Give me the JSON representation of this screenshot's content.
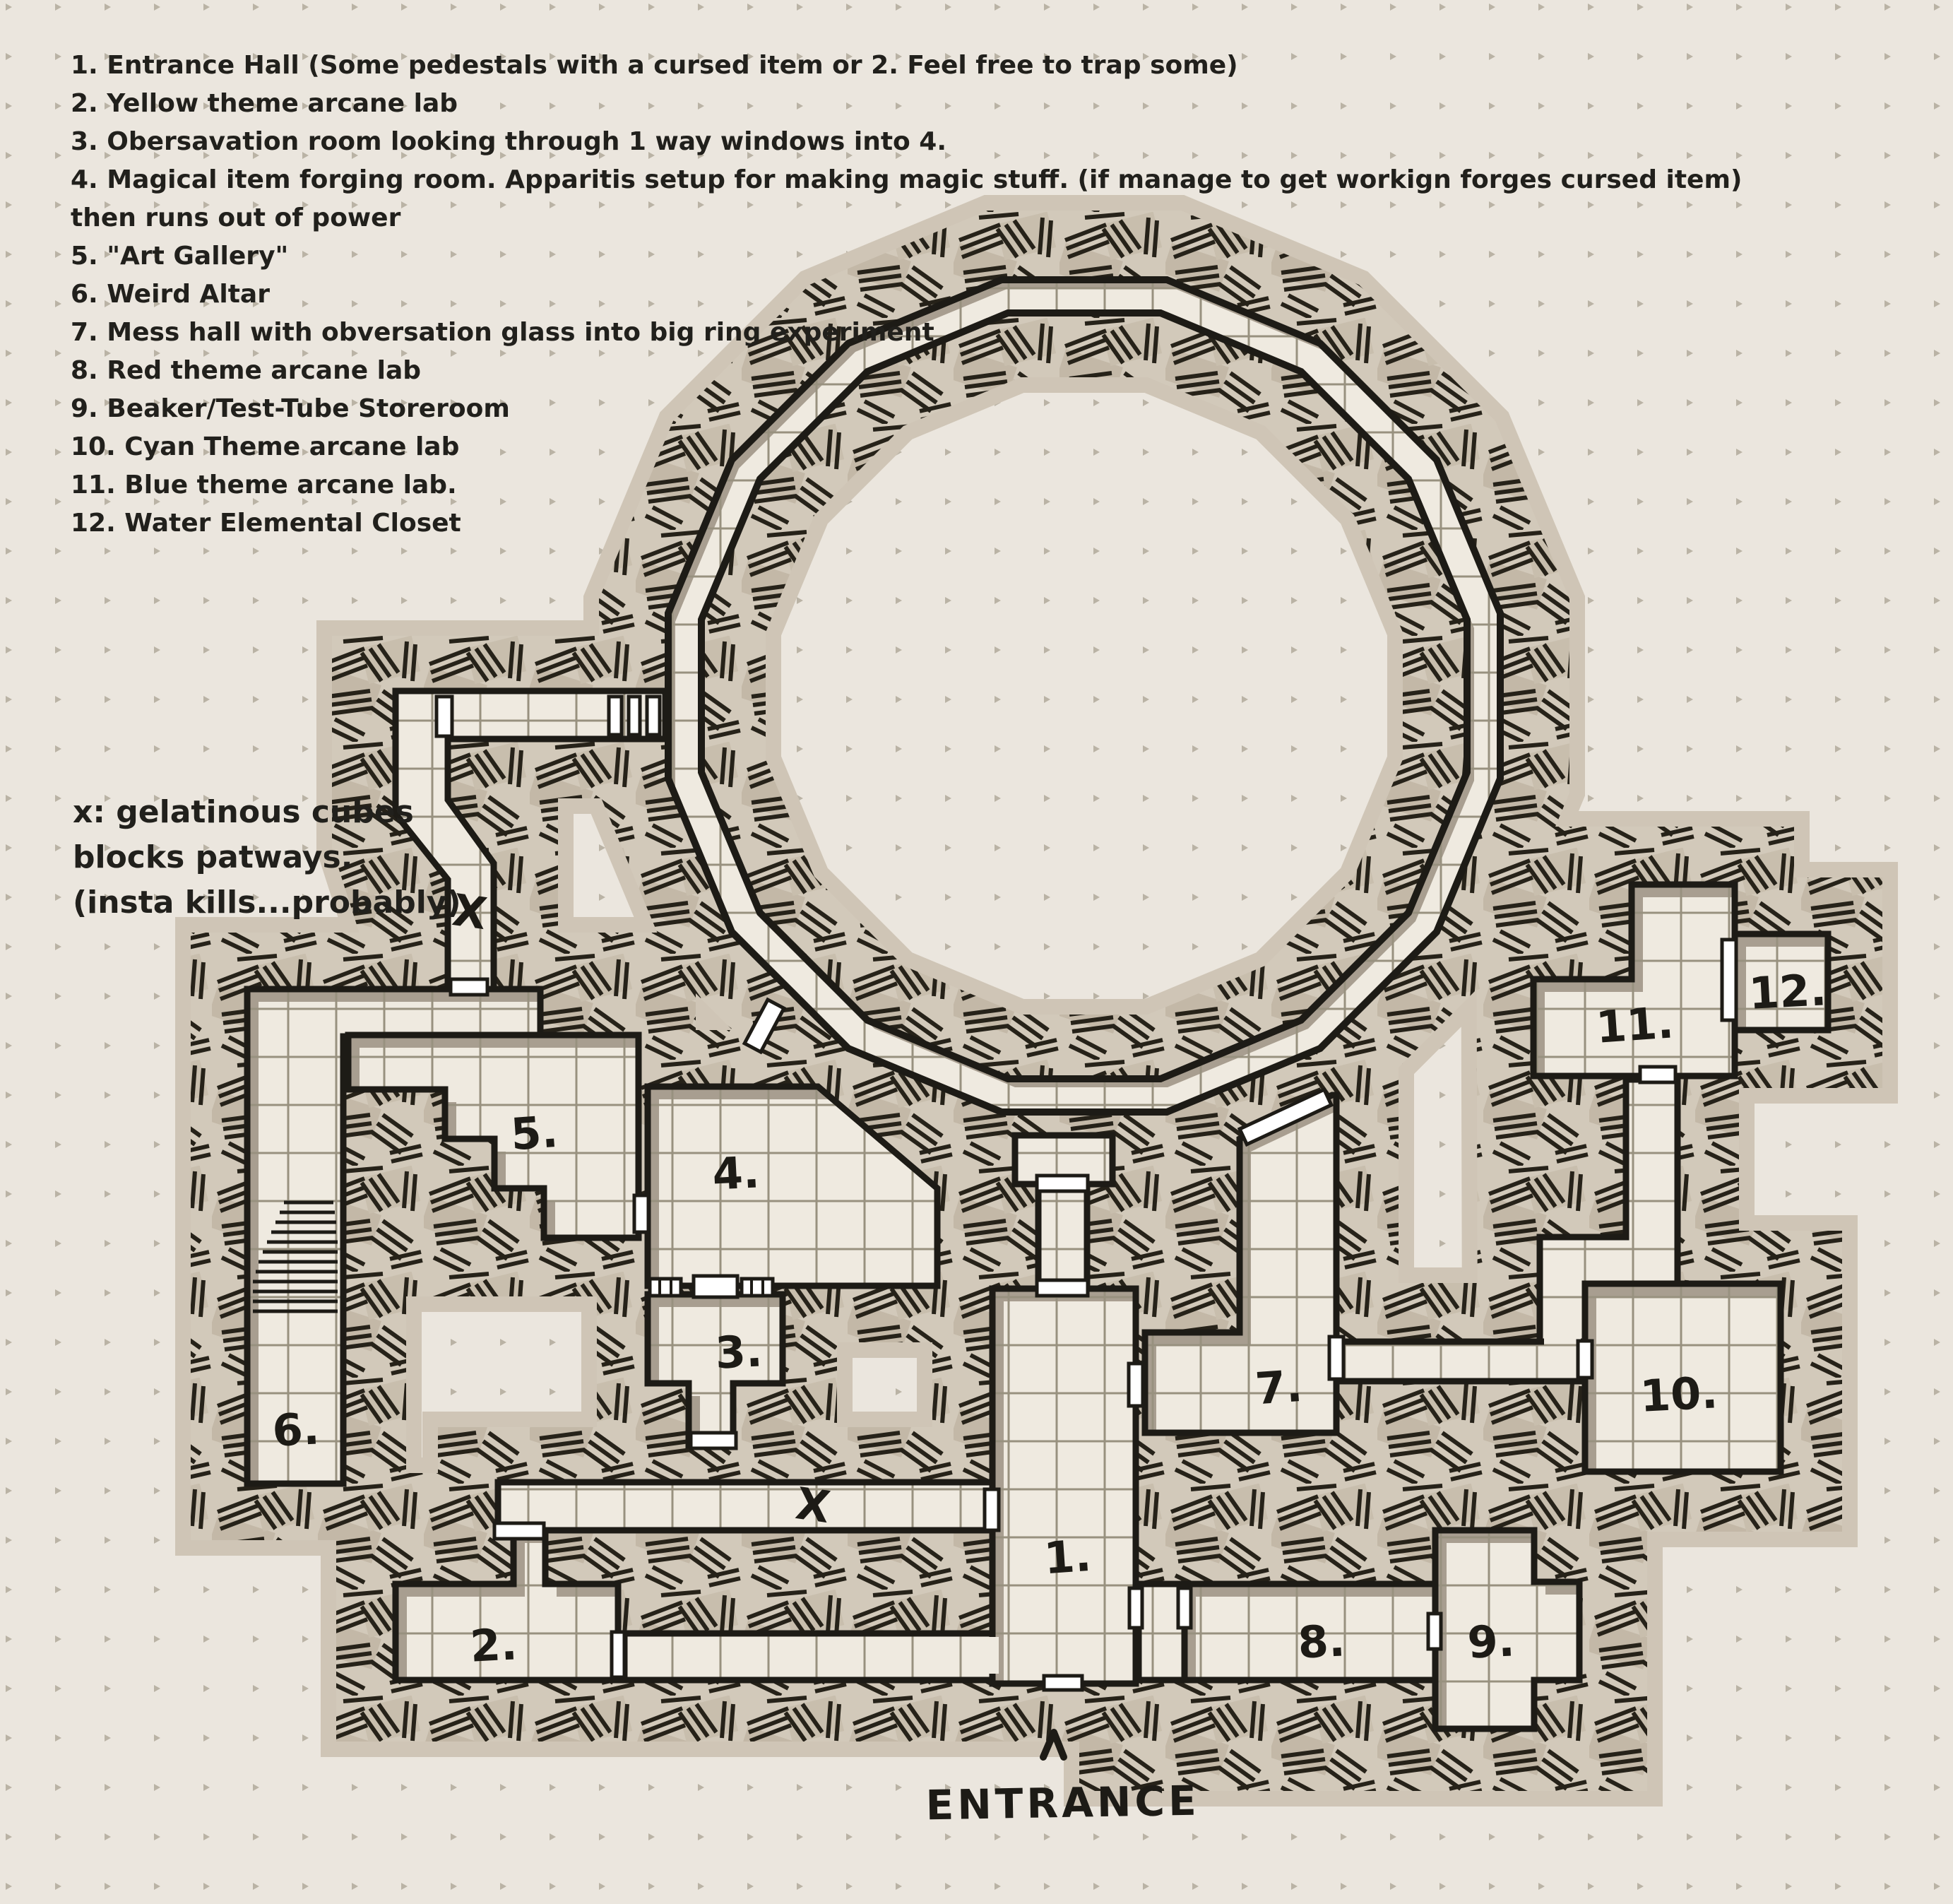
{
  "legend": {
    "items": [
      "1. Entrance Hall (Some pedestals with a cursed item or 2. Feel free to trap some)",
      "2. Yellow theme arcane lab",
      "3. Obersavation room looking through 1 way windows into 4.",
      "4. Magical item forging room. Apparitis setup for making magic stuff. (if manage to get workign forges cursed item)",
      "then runs out of power",
      "5. \"Art Gallery\"",
      "6. Weird Altar",
      "7. Mess hall with obversation glass into big ring experiment",
      "8. Red theme arcane lab",
      "9. Beaker/Test-Tube Storeroom",
      "10. Cyan Theme arcane lab",
      "11. Blue theme arcane lab.",
      "12. Water Elemental Closet"
    ]
  },
  "note": {
    "lines": [
      "x: gelatinous cubes",
      "blocks patways.",
      "(insta kills...probably)"
    ]
  },
  "rooms": [
    {
      "id": "1",
      "label": "1."
    },
    {
      "id": "2",
      "label": "2."
    },
    {
      "id": "3",
      "label": "3."
    },
    {
      "id": "4",
      "label": "4."
    },
    {
      "id": "5",
      "label": "5."
    },
    {
      "id": "6",
      "label": "6."
    },
    {
      "id": "7",
      "label": "7."
    },
    {
      "id": "8",
      "label": "8."
    },
    {
      "id": "9",
      "label": "9."
    },
    {
      "id": "10",
      "label": "10."
    },
    {
      "id": "11",
      "label": "11."
    },
    {
      "id": "12",
      "label": "12."
    }
  ],
  "markers": {
    "x_marks": [
      "X",
      "X"
    ],
    "entrance_label": "ENTRANCE",
    "entrance_arrow_icon": "chevron-up"
  },
  "colors": {
    "paper": "#ebe6de",
    "floor": "#efeae0",
    "ink": "#1d1b16",
    "hatch_tan": "#d2c9ba",
    "soft_rim": "#cfc5b6",
    "inner_shadow": "#a89e90",
    "grid_line": "#98917f",
    "door": "#ffffff"
  }
}
